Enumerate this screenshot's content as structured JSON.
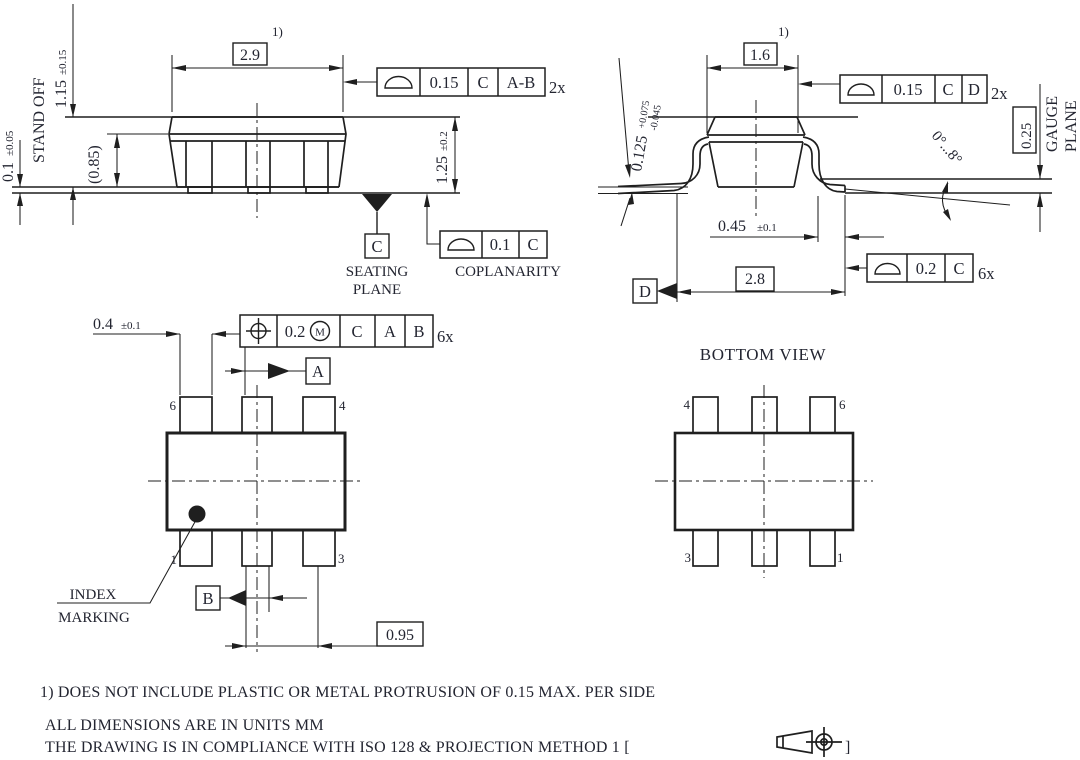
{
  "side_view": {
    "note_ref": "1)",
    "dim_width": "2.9",
    "dim_height_value": "1.15",
    "dim_height_tol": "±0.15",
    "standoff_value": "0.1",
    "standoff_tol": "±0.05",
    "standoff_label": "STAND OFF",
    "dim_inner": "(0.85)",
    "dim_total_value": "1.25",
    "dim_total_tol": "±0.2",
    "frame": {
      "tolerance": "0.15",
      "datum_c": "C",
      "datum_ab": "A-B",
      "count": "2x"
    },
    "seating_datum": "C",
    "seating_line1": "SEATING",
    "seating_line2": "PLANE",
    "coplanarity": {
      "tolerance": "0.1",
      "datum": "C",
      "label": "COPLANARITY"
    }
  },
  "end_view": {
    "note_ref": "1)",
    "dim_width": "1.6",
    "frame_top": {
      "tolerance": "0.15",
      "datum_c": "C",
      "datum_d": "D",
      "count": "2x"
    },
    "lead_thickness": {
      "value": "0.125",
      "plus": "+0.075",
      "minus": "-0.045"
    },
    "gauge": {
      "dim": "0.25",
      "line1": "GAUGE",
      "line2": "PLANE"
    },
    "angle": "0°...8°",
    "lead_width_value": "0.45",
    "lead_width_tol": "±0.1",
    "dim_span": "2.8",
    "datum_d": "D",
    "frame_bottom": {
      "tolerance": "0.2",
      "datum_c": "C",
      "count": "6x"
    }
  },
  "top_view": {
    "lead_dim_value": "0.4",
    "lead_dim_tol": "±0.1",
    "frame": {
      "tolerance": "0.2",
      "modifier": "M",
      "datum_c": "C",
      "datum_a": "A",
      "datum_b": "B",
      "count": "6x"
    },
    "datum_a": "A",
    "datum_b": "B",
    "pins": {
      "p6": "6",
      "p4": "4",
      "p1": "1",
      "p3": "3"
    },
    "index_line1": "INDEX",
    "index_line2": "MARKING",
    "pitch": "0.95"
  },
  "bottom_view": {
    "title": "BOTTOM VIEW",
    "pins": {
      "p4": "4",
      "p6": "6",
      "p3": "3",
      "p1": "1"
    }
  },
  "notes": {
    "line1": "1) DOES NOT INCLUDE PLASTIC OR METAL PROTRUSION OF 0.15 MAX. PER SIDE",
    "line2": "ALL DIMENSIONS ARE IN UNITS MM",
    "line3_text": "THE DRAWING IS IN COMPLIANCE WITH ISO 128 & PROJECTION METHOD 1 [",
    "line3_close": "]"
  },
  "colors": {
    "ink": "#1f1f1f",
    "text": "#232531",
    "background": "#ffffff"
  }
}
